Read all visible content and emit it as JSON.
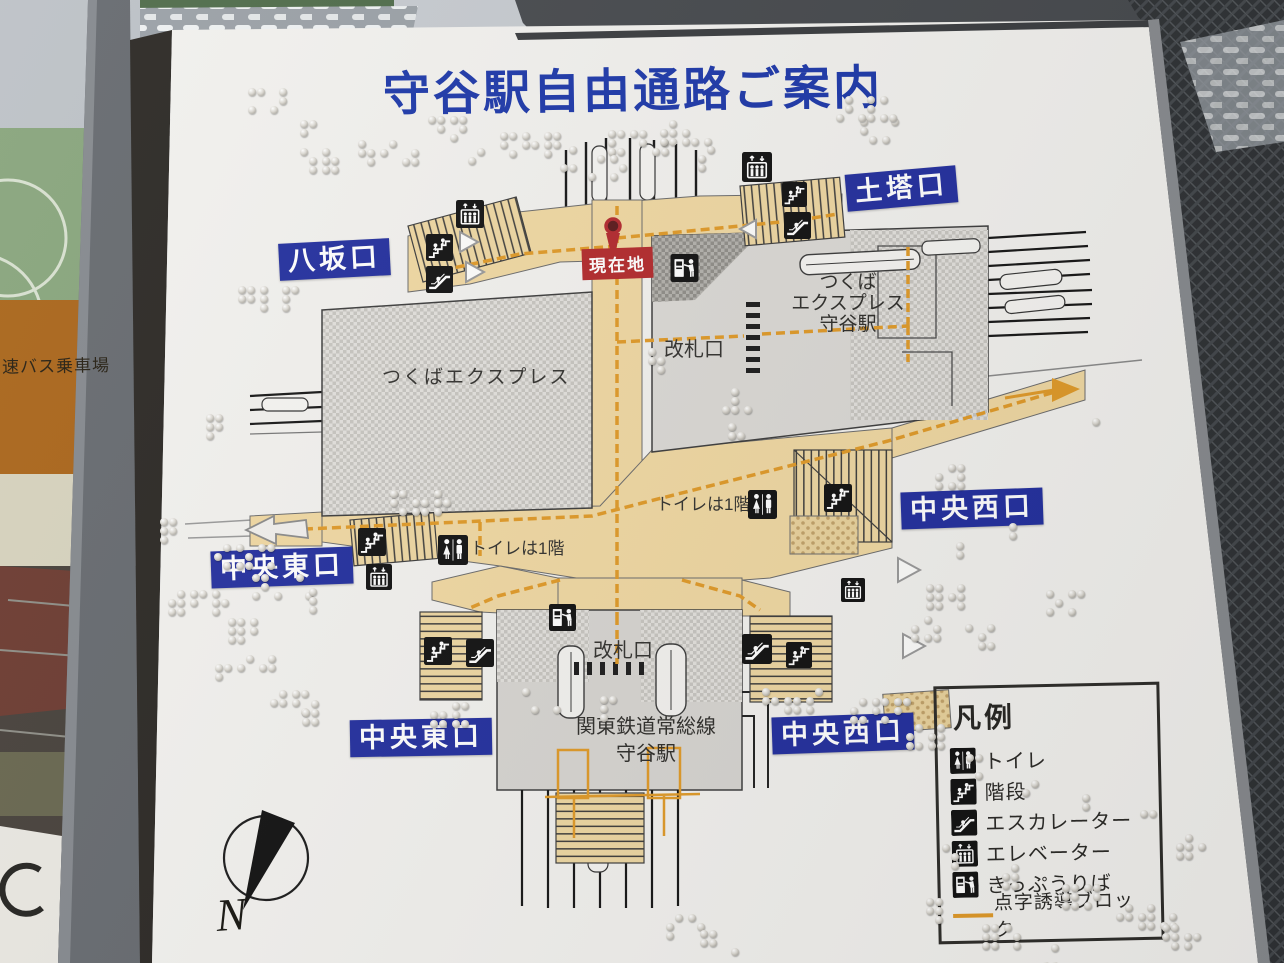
{
  "title": "守谷駅自由通路ご案内",
  "current_location": "現在地",
  "exits": {
    "dotou": "土塔口",
    "yasaka": "八坂口",
    "chuo_nishi_upper": "中央西口",
    "chuo_higashi_upper": "中央東口",
    "chuo_higashi_lower": "中央東口",
    "chuo_nishi_lower": "中央西口"
  },
  "stations": {
    "tx_area_label": "つくばエクスプレス",
    "tx_station": [
      "つくば",
      "エクスプレス",
      "守谷駅"
    ],
    "tx_gate_label": "改札口",
    "joso_gate_label": "改札口",
    "joso_station": [
      "関東鉄道常総線",
      "守谷駅"
    ]
  },
  "notes": {
    "toilet_right": "トイレは1階",
    "toilet_left": "トイレは1階"
  },
  "legend": {
    "title": "凡例",
    "items": [
      {
        "icon": "toilet-icon",
        "label": "トイレ"
      },
      {
        "icon": "stairs-icon",
        "label": "階段"
      },
      {
        "icon": "escalator-icon",
        "label": "エスカレーター"
      },
      {
        "icon": "elevator-icon",
        "label": "エレベーター"
      },
      {
        "icon": "ticket-machine-icon",
        "label": "きっぷうりば"
      },
      {
        "icon": "tactile-path-line",
        "label": "点字誘導ブロック"
      }
    ]
  },
  "compass": {
    "north": "N"
  },
  "surroundings": {
    "bus_sign": "高速バス乗車場"
  },
  "colors": {
    "title_blue": "#1d38a9",
    "exit_label_bg": "#232f9e",
    "current_red": "#b32a2c",
    "tactile_orange": "#e09a28",
    "passage_beige": "#f0d8a2"
  }
}
